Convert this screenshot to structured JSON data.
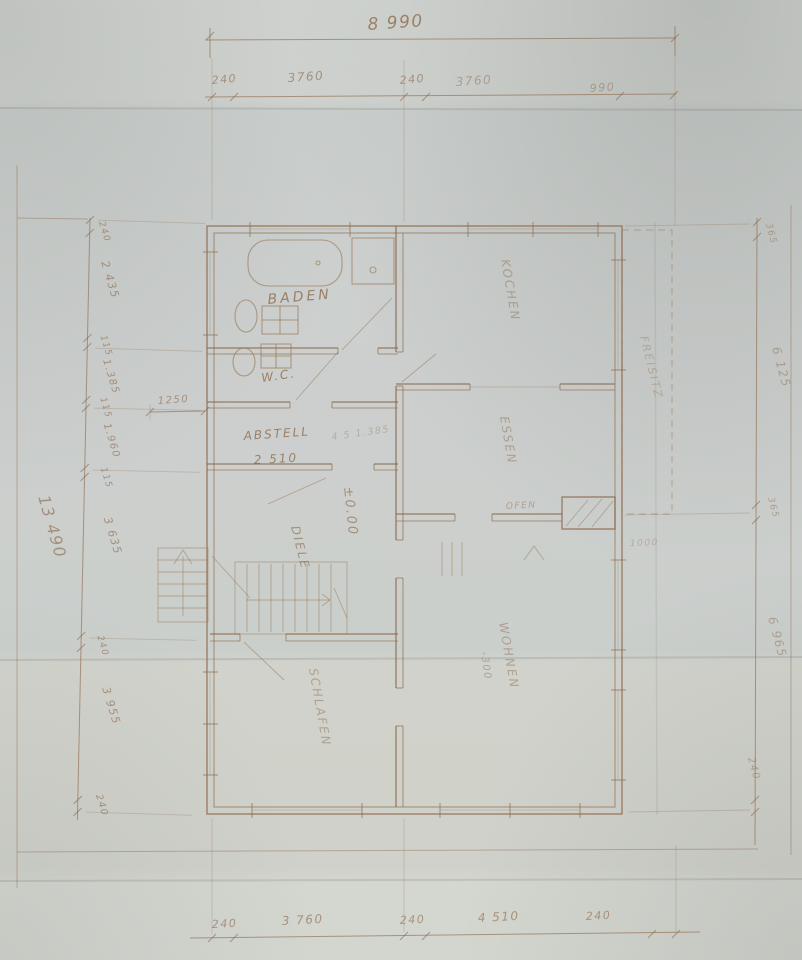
{
  "dims": {
    "top_total": "8 990",
    "top": [
      "240",
      "3760",
      "240",
      "3760",
      "990"
    ],
    "bottom": [
      "240",
      "3 760",
      "240",
      "4 510",
      "240"
    ],
    "left": [
      "240",
      "2 435",
      "115",
      "1.385",
      "115",
      "1.960",
      "115",
      "3 635",
      "240",
      "3 955",
      "240"
    ],
    "left_total": "13 490",
    "right": [
      "365",
      "6 125",
      "365",
      "6 965",
      "240"
    ]
  },
  "rooms": {
    "baden": "BADEN",
    "wc": "W.C.",
    "abstell": "ABSTELL",
    "abstell_size": "2 510",
    "diele": "DIELE",
    "kochen": "KOCHEN",
    "essen": "ESSEN",
    "wohnen": "WOHNEN",
    "schlafen": "SCHLAFEN",
    "freisitz": "FREISITZ",
    "ofen": "OFEN"
  },
  "levels": {
    "ground": "±0.00",
    "wohnen": "-300"
  },
  "notes": {
    "abstell_dim": "1250",
    "height_note": "4 5 1.385",
    "wohnen_dim": "1000"
  },
  "colors": {
    "ink": "#8a6546",
    "paper": "#cdd1ce"
  }
}
